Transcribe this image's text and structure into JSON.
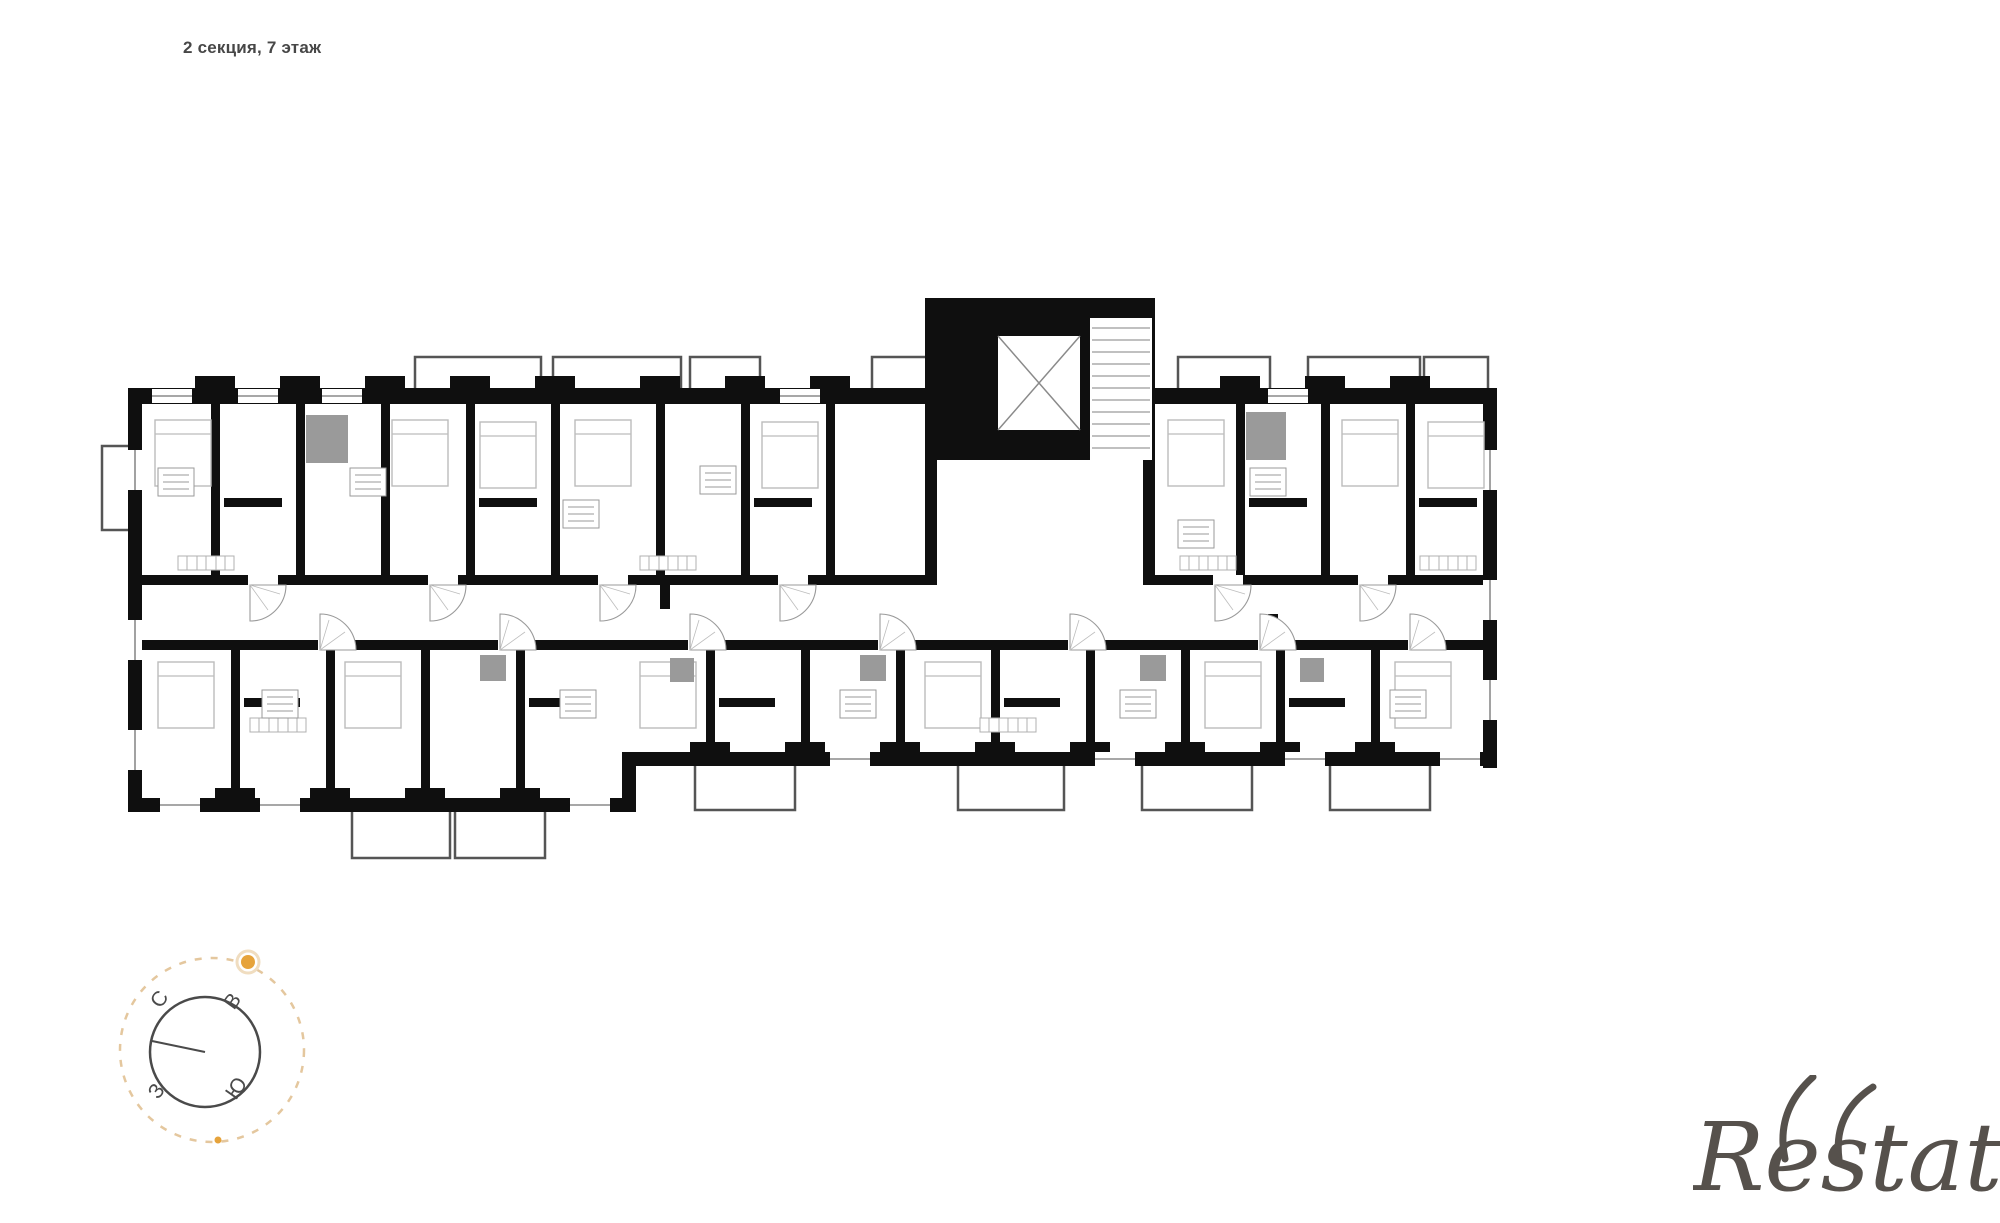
{
  "window": {
    "width": 2000,
    "height": 1223,
    "background": "#ffffff"
  },
  "header": {
    "title": "2 секция, 7 этаж",
    "color": "#474747"
  },
  "floorplan": {
    "name": "residential-floor-plan-section-2-floor-7",
    "wall_color": "#0f0f0f",
    "balcony_line_color": "#555555",
    "furniture_line_color": "#bcbcbc",
    "shaded_block_color": "#9a9a9a",
    "door_arc_color": "#9a9a9a"
  },
  "compass": {
    "labels": {
      "north": "С",
      "east": "В",
      "south": "Ю",
      "west": "З"
    },
    "label_color": "#4a4a4a",
    "ring_color": "#e4c79e",
    "needle_color": "#4a4a4a",
    "sun_color": "#e6a33b"
  },
  "watermark": {
    "text": "Restate",
    "color": "#56514c"
  }
}
